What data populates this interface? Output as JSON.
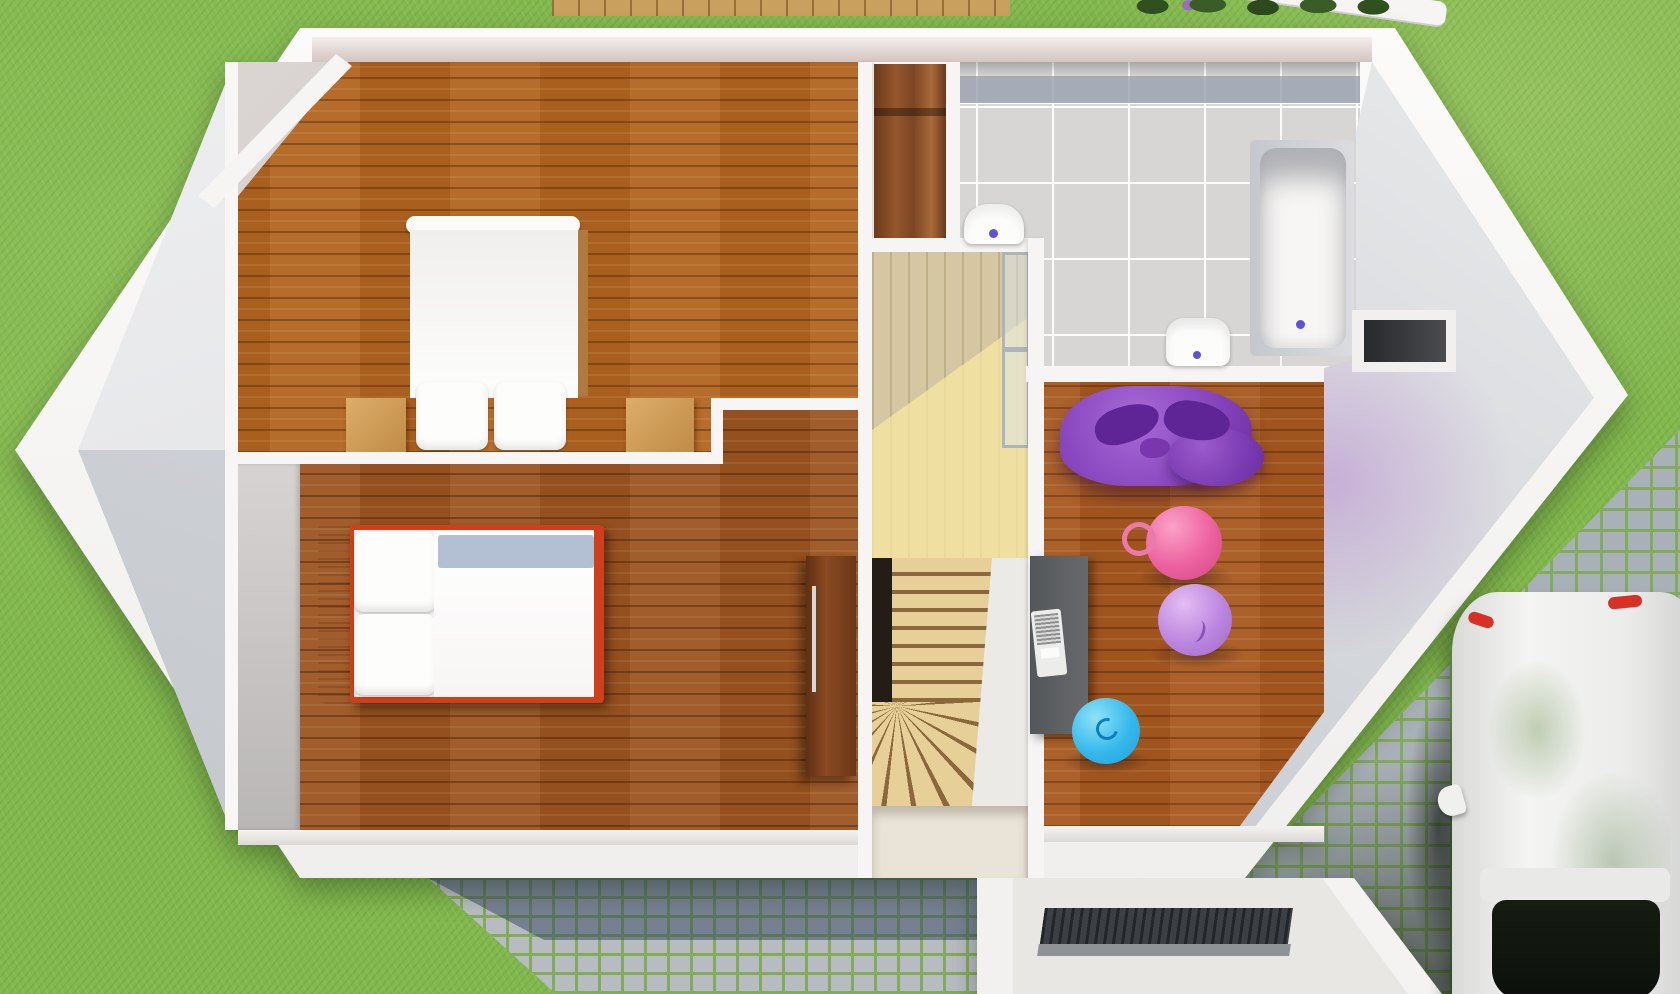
{
  "scene": {
    "type": "3d-floor-plan-render",
    "view": "top-down",
    "floor": "upper-floor",
    "description": "Architectural dollhouse render of an upper floor with two bedrooms, bathroom, winder staircase, playroom, entry porch, lawn and driveway with parked car"
  },
  "colors": {
    "grass": "#82b84d",
    "deck": "#c9a05e",
    "cobble": "#a9b1b8",
    "cobble-joint": "#82ab5c",
    "wall": "#f5f4f2",
    "wall-face": "#d3c5c1",
    "wood": "#b2641f",
    "wood2": "#9c5420",
    "tile": "#d7d6d4",
    "tile-dark": "#99a1b0",
    "grout": "#fdfdfd",
    "stair-tread": "#e6d098",
    "stair-riser": "#8a683c",
    "landing": "#d5c7a2",
    "void": "#241d17",
    "bed-red": "#cf3f1b",
    "sheet": "#b3c0d4",
    "desk": "#5d6063",
    "laptop": "#ececea",
    "beanbag": "#8a48c0",
    "beanbag-dark": "#5f2596",
    "ball-pink": "#ec619f",
    "ball-lavender": "#bb86e0",
    "ball-blue": "#35b9ec",
    "fixture-dot": "#5a52d8",
    "mat": "#3c4044",
    "mat-edge": "#8f9296",
    "porch": "#e9e7e3",
    "car-body": "#eff0ee",
    "car-glass": "#0d120c",
    "car-red": "#d93025",
    "glass-frame": "#aeb4bc"
  },
  "rooms": [
    {
      "id": "master-bedroom",
      "position": "top-left",
      "floor_material": "hardwood"
    },
    {
      "id": "kids-bedroom",
      "position": "bottom-left",
      "floor_material": "hardwood-dark"
    },
    {
      "id": "bathroom",
      "position": "top-right",
      "floor_material": "gray-tile"
    },
    {
      "id": "playroom",
      "position": "right",
      "floor_material": "hardwood"
    },
    {
      "id": "stair-hall",
      "position": "center",
      "floor_material": "light-wood"
    },
    {
      "id": "entry-porch",
      "position": "bottom",
      "floor_material": "concrete"
    }
  ],
  "furniture": [
    "double-bed-white",
    "nightstand-left",
    "nightstand-right",
    "built-in-closet",
    "single-bed-red",
    "wardrobe-dark-wood",
    "winder-staircase",
    "glass-balustrade",
    "wall-hung-toilet",
    "washbasin",
    "bathtub",
    "storage-niche",
    "desk-gray",
    "laptop",
    "purple-beanbag",
    "gym-ball-pink-with-handle",
    "gym-ball-lavender",
    "gym-ball-blue",
    "ribbed-doormat",
    "white-car",
    "patio-table"
  ],
  "environment": [
    "lawn",
    "hedge-row",
    "wooden-deck-edge",
    "cobblestone-path",
    "cobblestone-driveway"
  ]
}
